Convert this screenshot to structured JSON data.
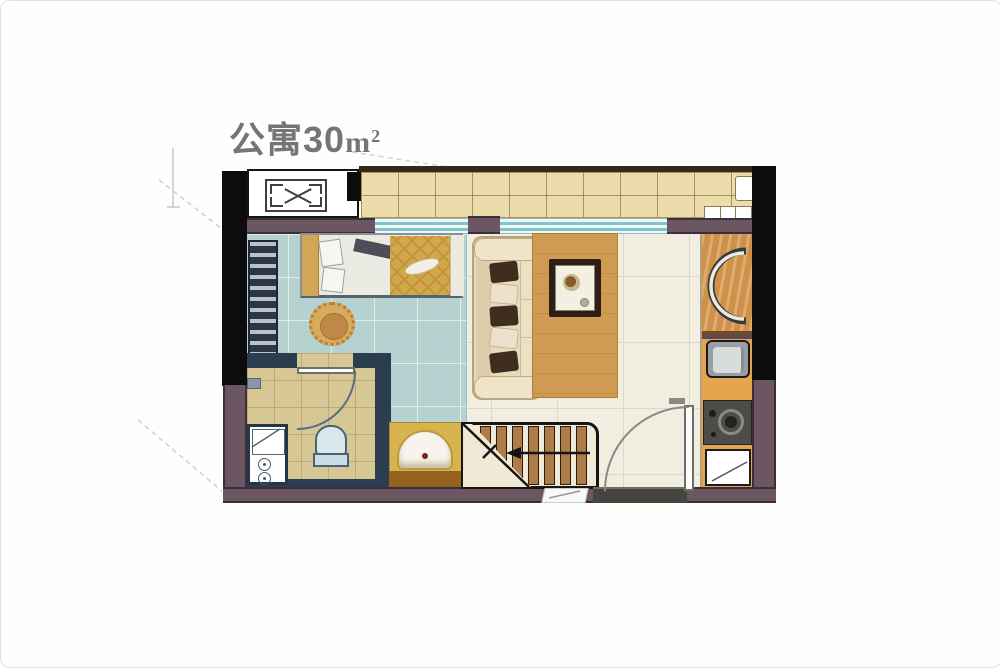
{
  "title": {
    "name": "公寓",
    "area": "30",
    "unit": "m",
    "unit_sup": "2",
    "full_text": "公寓30㎡"
  },
  "palette": {
    "wall_black": "#0c0c0c",
    "wall_purple": "#6b5662",
    "balcony_tile": "#ecdcab",
    "bedroom_floor": "#b5d1d0",
    "living_floor": "#f1eee1",
    "bathroom_floor": "#d7c795",
    "wood": "#cf9a52",
    "counter_gold": "#d9b44e",
    "title_gray": "#757575"
  },
  "plan": {
    "type": "apartment-floor-plan",
    "area_sqm": 30,
    "fixtures": [
      "ac-outdoor-unit-platform",
      "balcony",
      "wardrobe",
      "double-bed",
      "stool-chair",
      "sofa",
      "coffee-table",
      "area-rug",
      "bathroom-toilet",
      "bathroom-vanity",
      "washbasin-counter",
      "staircase",
      "entry-door",
      "kitchen-counter",
      "kitchen-sink",
      "gas-cooktop",
      "appliance-cabinet",
      "window"
    ]
  }
}
